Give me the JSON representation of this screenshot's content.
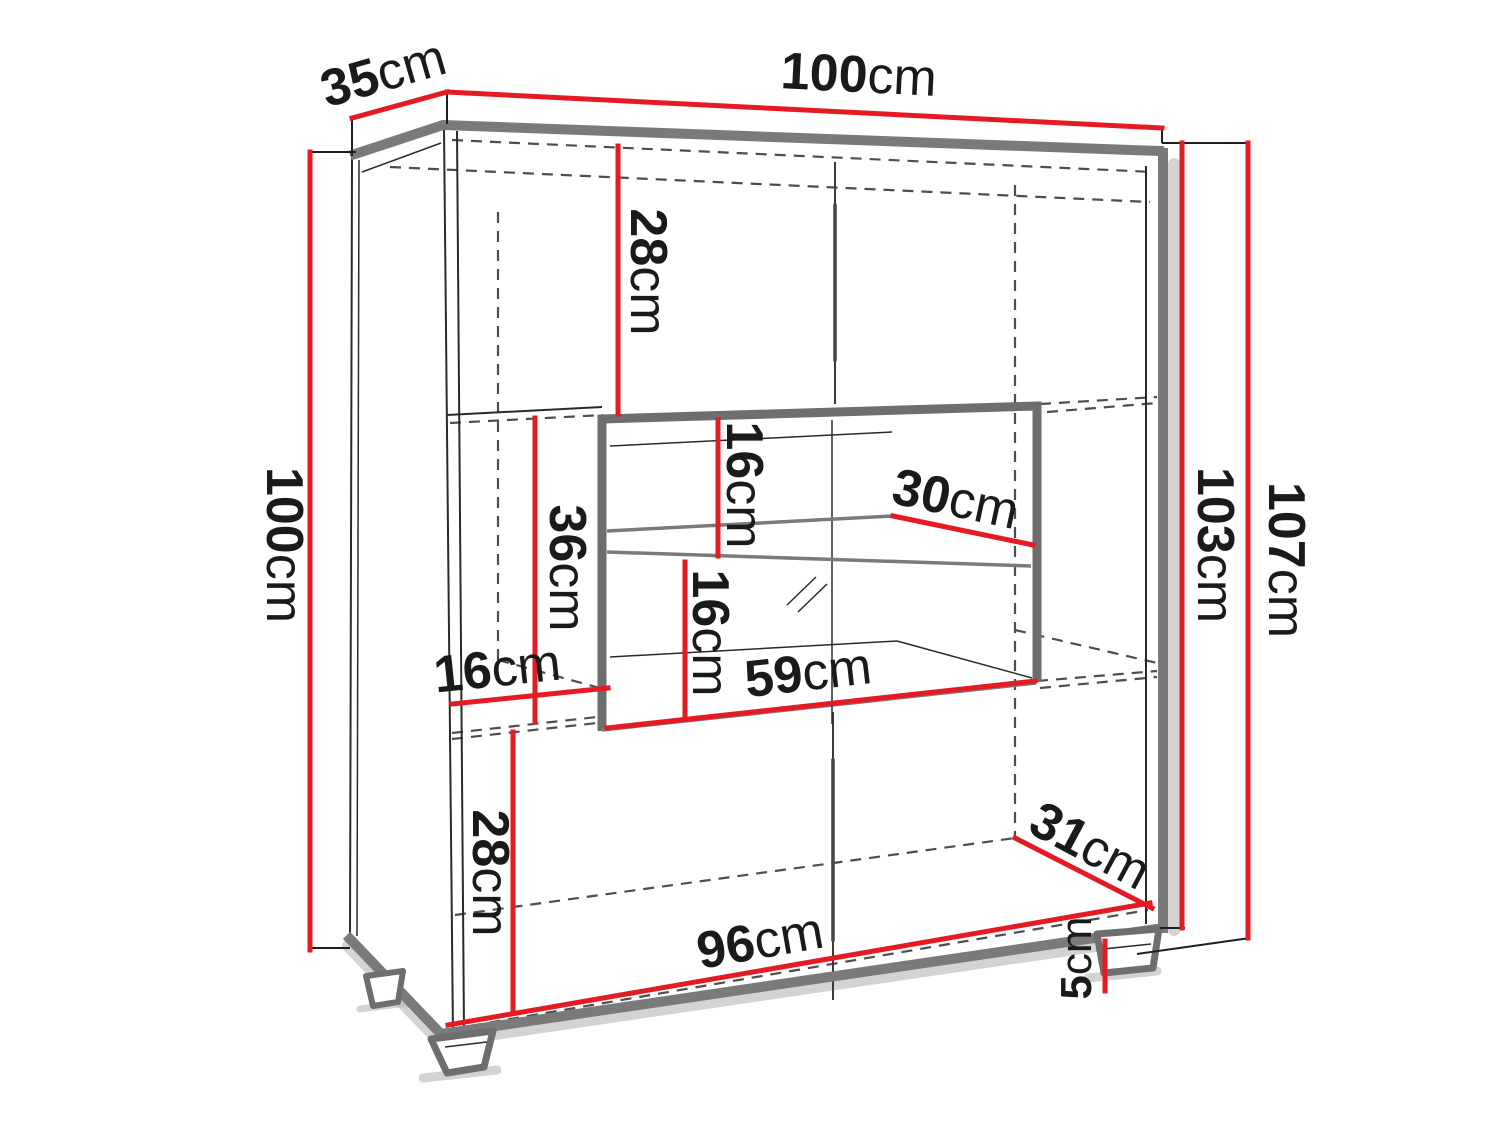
{
  "diagram": {
    "kind": "furniture-dimension-drawing",
    "unit": "cm"
  },
  "colors": {
    "dimension_red": "#e51b23",
    "structure_gray": "#7a7a7a",
    "hidden_edge_gray": "#4d4d4d",
    "outline_black": "#2a2a2a",
    "text_black": "#1a1a1a"
  },
  "labels": {
    "depth_top": {
      "value": "35",
      "unit": "cm"
    },
    "width_top": {
      "value": "100",
      "unit": "cm"
    },
    "height_left": {
      "value": "100",
      "unit": "cm"
    },
    "height_carcass": {
      "value": "103",
      "unit": "cm"
    },
    "height_total": {
      "value": "107",
      "unit": "cm"
    },
    "top_compartment_height": {
      "value": "28",
      "unit": "cm"
    },
    "niche_above_shelf_height": {
      "value": "16",
      "unit": "cm"
    },
    "shelf_depth": {
      "value": "30",
      "unit": "cm"
    },
    "middle_left_height": {
      "value": "36",
      "unit": "cm"
    },
    "niche_below_shelf_height": {
      "value": "16",
      "unit": "cm"
    },
    "middle_left_width": {
      "value": "16",
      "unit": "cm"
    },
    "niche_width": {
      "value": "59",
      "unit": "cm"
    },
    "bottom_compartment_height": {
      "value": "28",
      "unit": "cm"
    },
    "inner_width_bottom": {
      "value": "96",
      "unit": "cm"
    },
    "depth_bottom_inner": {
      "value": "31",
      "unit": "cm"
    },
    "leg_height": {
      "value": "5",
      "unit": "cm"
    }
  }
}
